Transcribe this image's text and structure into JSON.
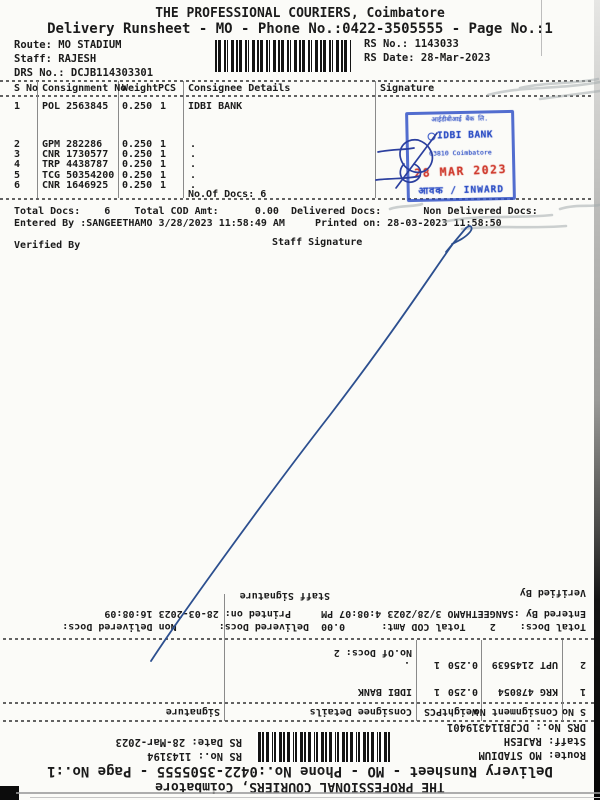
{
  "colors": {
    "paper": "#fbfbf8",
    "ink": "#1b1b1b",
    "pen_blue": "#2c4f8f",
    "stamp_blue": "#2a4cc4",
    "stamp_red": "#cf392c"
  },
  "top_doc": {
    "title": "THE PROFESSIONAL COURIERS, Coimbatore",
    "subtitle": "Delivery Runsheet - MO - Phone No.:0422-3505555 - Page No.:1",
    "route": "Route: MO STADIUM",
    "staff": "Staff: RAJESH",
    "drs_no": "DRS No.: DCJB114303301",
    "rs_no": "RS No.: 1143033",
    "rs_date": "RS Date: 28-Mar-2023",
    "table": {
      "headers": {
        "sno": "S No",
        "consignment": "Consignment No",
        "weight": "Weight",
        "pcs": "PCS",
        "consignee": "Consignee Details",
        "signature": "Signature"
      },
      "rows": [
        {
          "sno": "1",
          "consignment": "POL 2563845",
          "weight": "0.250",
          "pcs": "1",
          "consignee": "IDBI BANK"
        },
        {
          "sno": "2",
          "consignment": "GPM 282286",
          "weight": "0.250",
          "pcs": "1",
          "consignee": "."
        },
        {
          "sno": "3",
          "consignment": "CNR 1730577",
          "weight": "0.250",
          "pcs": "1",
          "consignee": "."
        },
        {
          "sno": "4",
          "consignment": "TRP 4438787",
          "weight": "0.250",
          "pcs": "1",
          "consignee": "."
        },
        {
          "sno": "5",
          "consignment": "TCG 50354200",
          "weight": "0.250",
          "pcs": "1",
          "consignee": "."
        },
        {
          "sno": "6",
          "consignment": "CNR 1646925",
          "weight": "0.250",
          "pcs": "1",
          "consignee": "."
        }
      ],
      "no_of_docs": "No.Of Docs: 6"
    },
    "totals_line": "Total Docs:    6    Total COD Amt:      0.00  Delivered Docs:       Non Delivered Docs:",
    "entered_line": "Entered By :SANGEETHAMO 3/28/2023 11:58:49 AM     Printed on: 28-03-2023 11:58:50",
    "verified_by": "Verified By",
    "staff_signature": "Staff Signature"
  },
  "stamp": {
    "line1": "आईडीबीआई बैंक लि.",
    "bank": "IDBI BANK",
    "branch": "03810 Coimbatore",
    "date_stamp": "28 MAR 2023",
    "inward": "आवक / INWARD"
  },
  "bottom_doc": {
    "title": "THE PROFESSIONAL COURIERS, Coimbatore",
    "subtitle": "Delivery Runsheet - MO - Phone No.:0422-3505555 - Page No.:1",
    "route": "Route: MO STADIUM",
    "staff": "Staff: RAJESH",
    "drs_no": "DRS No.: DCJB114319401",
    "rs_no": "RS No.: 1143194",
    "rs_date": "RS Date: 28-Mar-2023",
    "table": {
      "headers": {
        "sno": "S No",
        "consignment": "Consignment No",
        "weight": "Weight",
        "pcs": "PCS",
        "consignee": "Consignee Details",
        "signature": "Signature"
      },
      "rows": [
        {
          "sno": "1",
          "consignment": "KRG 478054",
          "weight": "0.250",
          "pcs": "1",
          "consignee": "IDBI BANK"
        },
        {
          "sno": "2",
          "consignment": "UPT 2145639",
          "weight": "0.250",
          "pcs": "1",
          "consignee": "."
        }
      ],
      "no_of_docs": "No.Of Docs: 2"
    },
    "totals_line": "Total Docs:    2    Total COD Amt:      0.00  Delivered Docs:       Non Delivered Docs:",
    "entered_line": "Entered By :SANGEETHAMO 3/28/2023 4:08:07 PM     Printed on: 28-03-2023 16:08:09",
    "verified_by": "Verified By",
    "staff_signature": "Staff Signature"
  }
}
